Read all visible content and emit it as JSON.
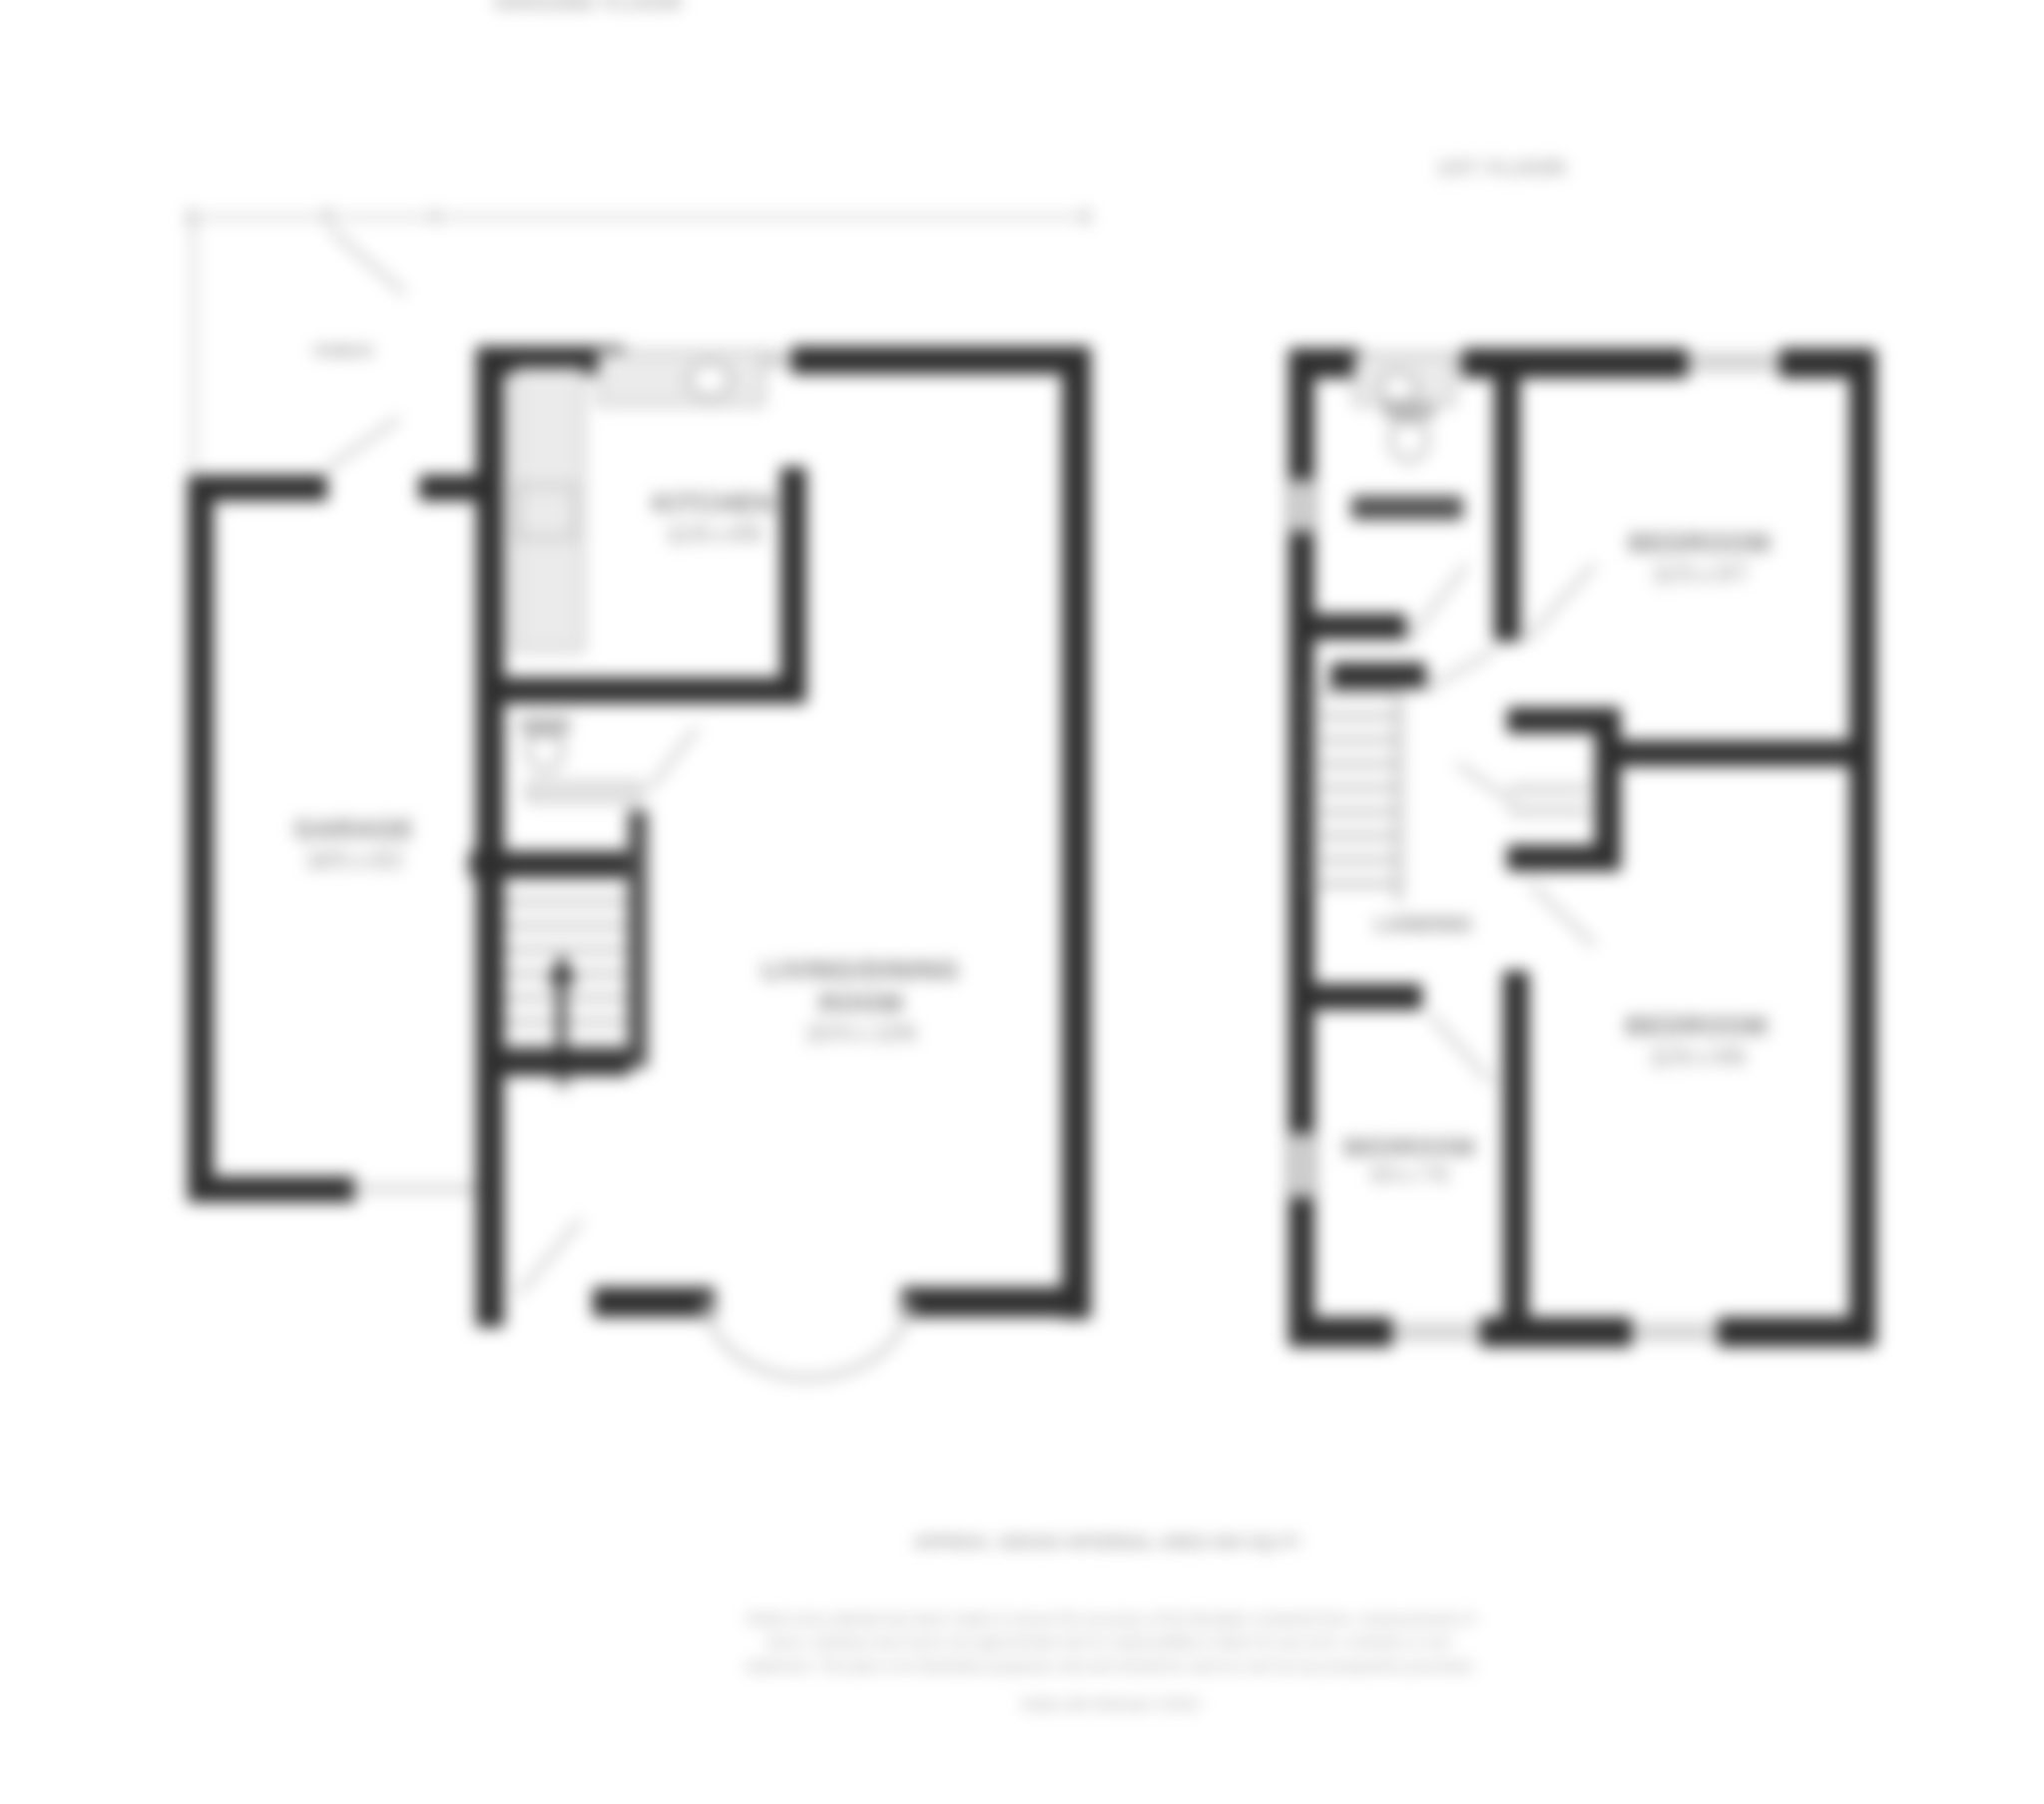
{
  "ground_floor": {
    "title": "GROUND FLOOR",
    "porch": {
      "name": "PORCH"
    },
    "garage": {
      "name": "GARAGE",
      "dims": "16'5 x 8'2"
    },
    "kitchen": {
      "name": "KITCHEN",
      "dims": "11'8 x 8'9"
    },
    "living": {
      "name": "LIVING/DINING ROOM",
      "dims": "22'4 x 13'6"
    },
    "stairs_direction": "UP"
  },
  "first_floor": {
    "title": "1ST FLOOR",
    "landing": {
      "name": "LANDING"
    },
    "bedroom1": {
      "name": "BEDROOM",
      "dims": "11'5 x 9'7"
    },
    "bedroom2": {
      "name": "BEDROOM",
      "dims": "11'6 x 9'8"
    },
    "bedroom3": {
      "name": "BEDROOM",
      "dims": "8'4 x 7'9"
    }
  },
  "footer": {
    "area_line": "APPROX. GROSS INTERNAL AREA 904 SQ FT",
    "disclaimer": "Whilst every attempt has been made to ensure the accuracy of the floorplan contained here, measurements of doors, windows and rooms are approximate and no responsibility is taken for any error, omission or mis-statement. This plan is for illustrative purposes only and should be used as such by any prospective purchaser.",
    "credit": "Made with Metropix ©2023"
  },
  "colors": {
    "wall": "#2e2e2e",
    "window": "#d4d4d4",
    "fixture_outline": "#8a8a8a",
    "counter_fill": "#ebebeb",
    "label_text": "#757575",
    "background": "#ffffff"
  }
}
